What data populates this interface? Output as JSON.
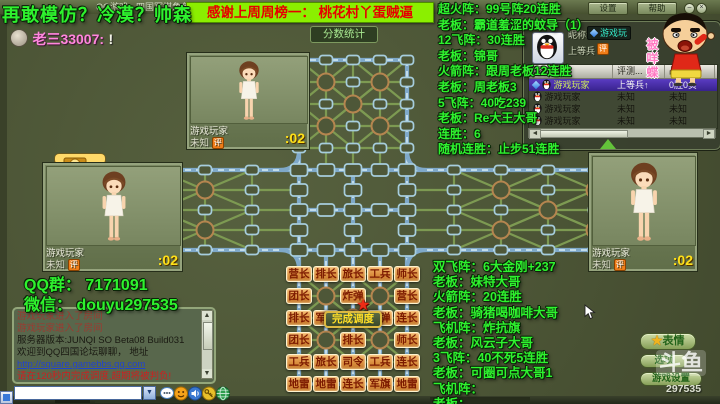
{
  "title_bar": {
    "title": "QQ游戏 - 四国军棋角色版 公测版 Beta08 Build031",
    "settings": "设置",
    "help": "帮助",
    "minimize": "–",
    "close": "×"
  },
  "overlay": {
    "warning": "再敢模仿？冷漠？帅森",
    "banner": "感谢上周周榜一： 桃花村丫蛋贼逼",
    "qq_group": "QQ群： 7171091",
    "wechat": "微信： douyu297535",
    "top_list": [
      "超火阵：99号阵20连胜",
      "老板：霸道羞涩的蚊导（1）",
      "12飞阵：30连胜",
      "老板：锦哥",
      "火箭阵：跟周老板12连胜",
      "老板：周老板3",
      "5飞阵：40吃239",
      "老板：Re大王大哥",
      "连胜：6",
      "随机连胜：止步51连胜"
    ],
    "bottom_list": [
      "双飞阵：6大金刚+237",
      "老板：妹特大哥",
      "火箭阵：20连胜",
      "老板：骑猪喝咖啡大哥",
      "飞机阵：炸抗旗",
      "老板：风云子大哥",
      "3飞阵：40不死5连胜",
      "老板：可圈可点大哥1",
      "飞机阵：",
      "老板："
    ]
  },
  "chat_line": {
    "author": "老三33007:",
    "text": "!"
  },
  "score_button": "分数统计",
  "treasure": {
    "label": "夺宝"
  },
  "players": {
    "top": {
      "name": "游戏玩家",
      "rank": "未知",
      "badge": "评",
      "timer": ":02"
    },
    "left": {
      "name": "游戏玩家",
      "rank": "未知",
      "badge": "评",
      "timer": ":02"
    },
    "right": {
      "name": "游戏玩家",
      "rank": "未知",
      "badge": "评",
      "timer": ":02"
    }
  },
  "info_panel": {
    "nickname_label": "昵称:",
    "nickname_value": "游戏玩",
    "rank_value": "上等兵",
    "badge": "评",
    "table": {
      "headers": [
        "昵称",
        "评测...",
        "战绩"
      ],
      "rows": [
        {
          "name": "游戏玩家",
          "rank": "上等兵↑",
          "record": "0胜0负",
          "selected": true,
          "qq": true
        },
        {
          "name": "游戏玩家",
          "rank": "未知",
          "record": "未知",
          "selected": false,
          "qq": false
        },
        {
          "name": "游戏玩家",
          "rank": "未知",
          "record": "未知",
          "selected": false,
          "qq": false
        },
        {
          "name": "游戏玩家",
          "rank": "未知",
          "record": "未知",
          "selected": false,
          "qq": false
        }
      ]
    }
  },
  "board": {
    "deploy_button": "完成调度",
    "rows": [
      [
        "营长",
        "排长",
        "旅长",
        "工兵",
        "师长"
      ],
      [
        "团长",
        null,
        "炸弹",
        null,
        "营长"
      ],
      [
        "排长",
        "军长",
        null,
        "炸弹",
        "连长"
      ],
      [
        "团长",
        null,
        "排长",
        null,
        "师长"
      ],
      [
        "工兵",
        "旅长",
        "司令",
        "工兵",
        "连长"
      ],
      [
        "地雷",
        "地雷",
        "连长",
        "军旗",
        "地雷"
      ]
    ]
  },
  "chat_panel": {
    "messages": [
      {
        "text": "游戏玩家进入了房间",
        "color": "#9c3a30"
      },
      {
        "text": "游戏玩家进入了房间",
        "color": "#9c3a30"
      },
      {
        "text": "服务器版本:JUNQI SO Beta08 Build031",
        "color": "#1a1a12"
      },
      {
        "text": "欢迎到QQ四国论坛聊聊， 地址",
        "color": "#1a1a12"
      },
      {
        "text": "http://square.gamebbs.qq.com",
        "color": "#2244cc",
        "underline": true
      },
      {
        "text": "请在120秒内完成调度,超期将被判负!",
        "color": "#cc2020"
      }
    ]
  },
  "buttons": {
    "emote": "表情",
    "option": "选项",
    "game": "游戏设置"
  },
  "watermark": {
    "logo": "斗鱼",
    "number": "297535"
  },
  "sticker": {
    "text": "被咩蝶"
  },
  "colors": {
    "accent_green": "#2ef22e",
    "banner_bg": "#8bef00",
    "piece_orange": "#da8e3e",
    "railway_blue": "#7fa9c9"
  }
}
